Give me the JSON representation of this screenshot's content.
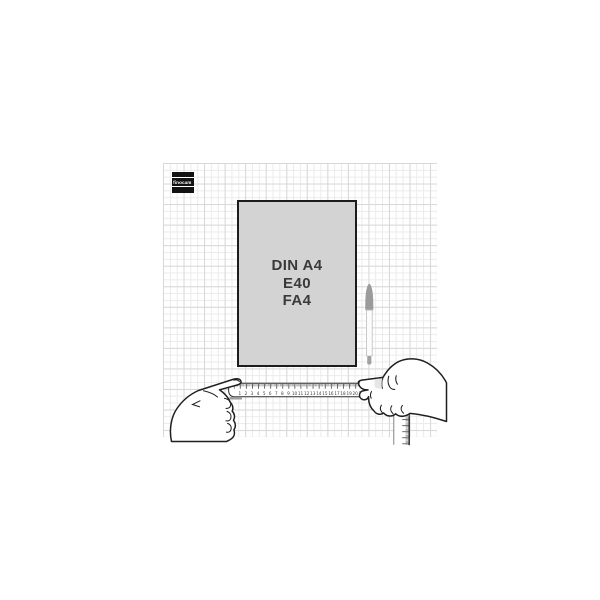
{
  "colors": {
    "page_bg": "#ffffff",
    "paper_fill": "#d3d3d3",
    "paper_border": "#1c1c1c",
    "grid_minor": "#ebebeb",
    "grid_major": "#d8d8d8",
    "ink": "#1f1f1f",
    "pen_gray": "#9b9b9b",
    "label_text": "#3a3a3a"
  },
  "illustration": {
    "brand_logo": {
      "text": "finocam"
    },
    "paper": {
      "lines": [
        "DIN A4",
        "E40",
        "FA4"
      ]
    },
    "horizontal_ruler": {
      "cm_labels": [
        "1",
        "2",
        "3",
        "4",
        "5",
        "6",
        "7",
        "8",
        "9",
        "10",
        "11",
        "12",
        "13",
        "14",
        "15",
        "16",
        "17",
        "18",
        "19",
        "20",
        "21"
      ]
    }
  }
}
